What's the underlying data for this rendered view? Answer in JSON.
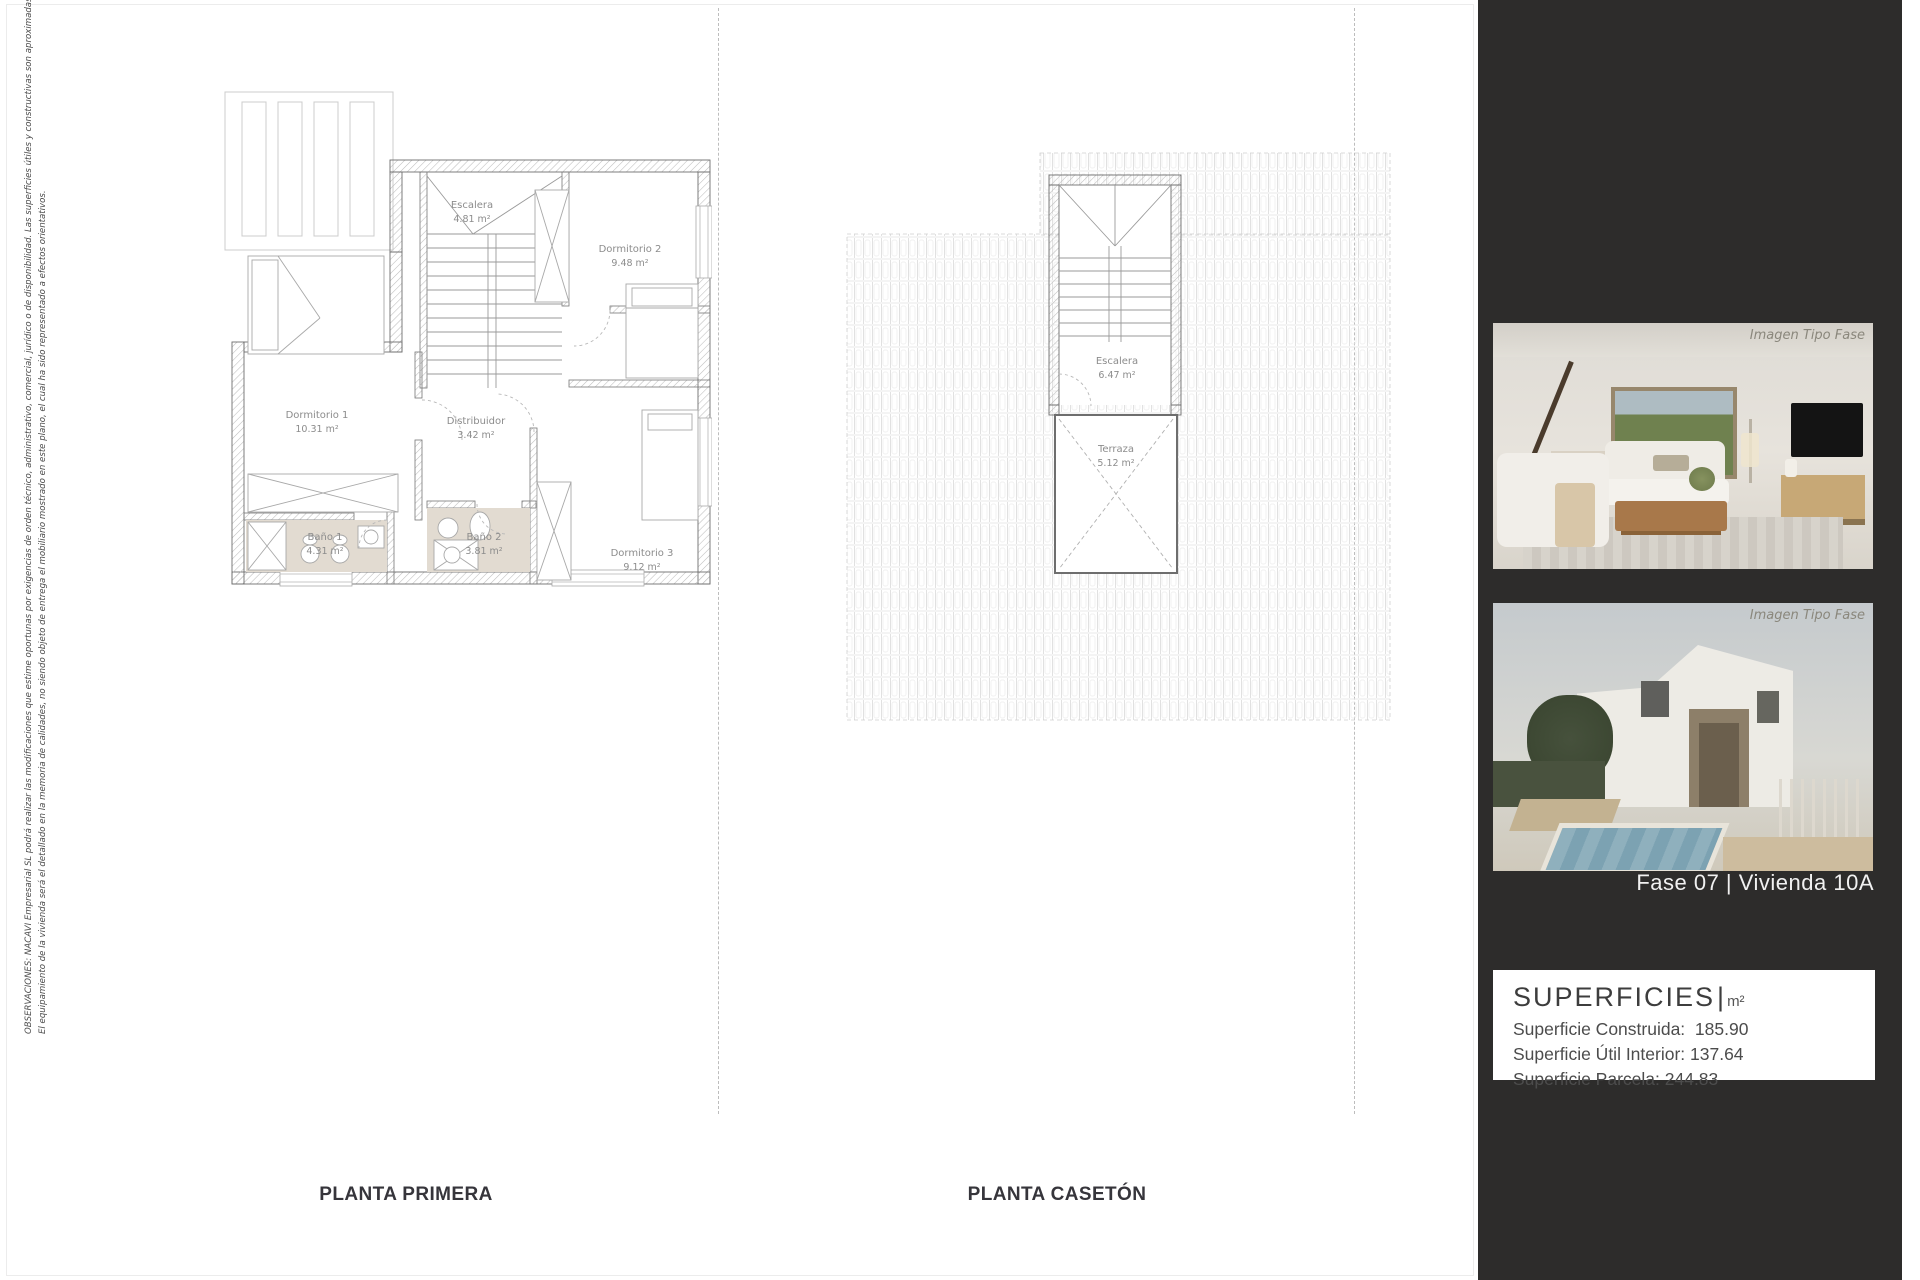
{
  "disclaimer": {
    "line1": "OBSERVACIONES: NACAVI Empresarial SL podrá realizar las modificaciones que estime oportunas por exigencias de orden técnico, administrativo, comercial, jurídico o de disponibilidad. Las superficies útiles y constructivas son aproximadas.",
    "line2": "El equipamiento de la vivienda será el detallado en la memoria de calidades, no siendo objeto de entrega el mobiliario mostrado en este plano, el  cual ha sido representado a efectos orientativos."
  },
  "plans": {
    "planta_primera": {
      "label": "PLANTA PRIMERA",
      "rooms": [
        {
          "name": "Escalera",
          "area": "4.81 m²"
        },
        {
          "name": "Dormitorio 2",
          "area": "9.48 m²"
        },
        {
          "name": "Dormitorio 1",
          "area": "10.31 m²"
        },
        {
          "name": "Distribuidor",
          "area": "3.42 m²"
        },
        {
          "name": "Baño 1",
          "area": "4.31 m²"
        },
        {
          "name": "Baño 2",
          "area": "3.81 m²"
        },
        {
          "name": "Dormitorio 3",
          "area": "9.12 m²"
        }
      ]
    },
    "planta_caseton": {
      "label": "PLANTA CASETÓN",
      "rooms": [
        {
          "name": "Escalera",
          "area": "6.47 m²"
        },
        {
          "name": "Terraza",
          "area": "5.12 m²"
        }
      ]
    }
  },
  "sidebar": {
    "photo_caption": "Imagen Tipo Fase",
    "unit_title": "Fase 07 |  Vivienda 10A",
    "superficies": {
      "title": "SUPERFICIES",
      "separator": "|",
      "unit": "m²",
      "rows": [
        "Superficie Construida:  185.90",
        "Superficie Útil Interior: 137.64",
        "Superficie Parcela: 244.83"
      ]
    }
  },
  "colors": {
    "panel_bg": "#2d2c2b",
    "bath_floor": "#e2dbd1",
    "plan_line": "#6e6e6e",
    "label_gray": "#8c8c8c",
    "title_dark": "#36353b"
  }
}
